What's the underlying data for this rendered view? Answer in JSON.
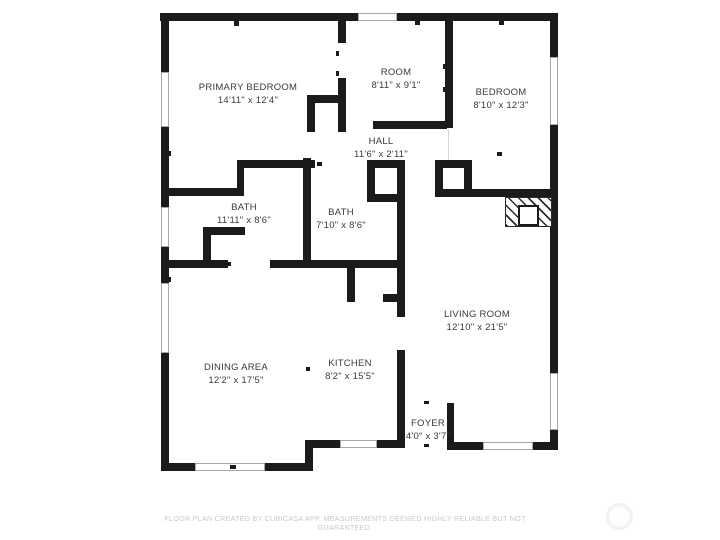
{
  "page": {
    "background": "#ffffff",
    "wall_color": "#1b1b1b",
    "label_color": "#3a3a3a",
    "window_border_color": "#a8a8a8",
    "footer_color": "#c9c9c9"
  },
  "footer": {
    "disclaimer": "FLOOR PLAN CREATED BY CUBICASA APP. MEASUREMENTS DEEMED HIGHLY RELIABLE BUT NOT GUARANTEED."
  },
  "rooms": [
    {
      "name": "PRIMARY BEDROOM",
      "dims": "14'11\" x 12'4\"",
      "cx": 248,
      "cy": 94
    },
    {
      "name": "ROOM",
      "dims": "8'11\" x 9'1\"",
      "cx": 396,
      "cy": 79
    },
    {
      "name": "BEDROOM",
      "dims": "8'10\" x 12'3\"",
      "cx": 501,
      "cy": 99
    },
    {
      "name": "HALL",
      "dims": "11'6\" x 2'11\"",
      "cx": 381,
      "cy": 148
    },
    {
      "name": "BATH",
      "dims": "11'11\" x 8'6\"",
      "cx": 244,
      "cy": 214
    },
    {
      "name": "BATH",
      "dims": "7'10\" x 8'6\"",
      "cx": 341,
      "cy": 219
    },
    {
      "name": "LIVING ROOM",
      "dims": "12'10\" x 21'5\"",
      "cx": 477,
      "cy": 321
    },
    {
      "name": "DINING AREA",
      "dims": "12'2\" x 17'5\"",
      "cx": 236,
      "cy": 374
    },
    {
      "name": "KITCHEN",
      "dims": "8'2\" x 15'5\"",
      "cx": 350,
      "cy": 370
    },
    {
      "name": "FOYER",
      "dims": "4'0\" x 3'7\"",
      "cx": 428,
      "cy": 430
    }
  ],
  "geometry": {
    "walls": [
      [
        160,
        13,
        198,
        8
      ],
      [
        397,
        13,
        161,
        8
      ],
      [
        161,
        13,
        8,
        59
      ],
      [
        161,
        127,
        8,
        80
      ],
      [
        161,
        247,
        8,
        36
      ],
      [
        161,
        353,
        8,
        118
      ],
      [
        161,
        463,
        34,
        8
      ],
      [
        265,
        463,
        48,
        8
      ],
      [
        305,
        440,
        8,
        31
      ],
      [
        305,
        440,
        35,
        8
      ],
      [
        377,
        440,
        26,
        8
      ],
      [
        397,
        350,
        8,
        98
      ],
      [
        447,
        442,
        36,
        8
      ],
      [
        533,
        442,
        25,
        8
      ],
      [
        447,
        403,
        7,
        42
      ],
      [
        550,
        13,
        8,
        44
      ],
      [
        550,
        125,
        8,
        248
      ],
      [
        550,
        430,
        8,
        20
      ],
      [
        338,
        21,
        8,
        22
      ],
      [
        338,
        78,
        8,
        54
      ],
      [
        307,
        95,
        36,
        8
      ],
      [
        307,
        103,
        8,
        29
      ],
      [
        373,
        121,
        74,
        8
      ],
      [
        445,
        21,
        8,
        107
      ],
      [
        237,
        160,
        78,
        8
      ],
      [
        237,
        160,
        7,
        36
      ],
      [
        165,
        188,
        79,
        8
      ],
      [
        203,
        227,
        8,
        33
      ],
      [
        203,
        227,
        42,
        8
      ],
      [
        303,
        158,
        8,
        110
      ],
      [
        397,
        160,
        8,
        157
      ],
      [
        367,
        160,
        8,
        42
      ],
      [
        367,
        194,
        36,
        8
      ],
      [
        367,
        160,
        36,
        8
      ],
      [
        161,
        260,
        67,
        8
      ],
      [
        270,
        260,
        135,
        8
      ],
      [
        347,
        260,
        8,
        42
      ],
      [
        383,
        294,
        22,
        8
      ],
      [
        435,
        160,
        8,
        37
      ],
      [
        464,
        160,
        8,
        37
      ],
      [
        435,
        160,
        37,
        8
      ],
      [
        435,
        189,
        118,
        8
      ]
    ],
    "windows": [
      [
        161,
        72,
        8,
        55
      ],
      [
        161,
        207,
        8,
        40
      ],
      [
        161,
        283,
        8,
        70
      ],
      [
        358,
        13,
        39,
        8
      ],
      [
        550,
        57,
        8,
        68
      ],
      [
        550,
        373,
        8,
        57
      ],
      [
        195,
        463,
        70,
        8
      ],
      [
        340,
        440,
        37,
        8
      ],
      [
        483,
        442,
        50,
        8
      ]
    ],
    "ticks": [
      [
        234,
        21,
        5,
        5
      ],
      [
        415,
        21,
        5,
        4
      ],
      [
        499,
        21,
        5,
        4
      ],
      [
        168,
        151,
        3,
        5
      ],
      [
        168,
        277,
        3,
        5
      ],
      [
        443,
        64,
        3,
        5
      ],
      [
        443,
        87,
        3,
        5
      ],
      [
        336,
        51,
        3,
        5
      ],
      [
        336,
        71,
        3,
        5
      ],
      [
        227,
        262,
        4,
        4
      ],
      [
        308,
        206,
        3,
        5
      ],
      [
        308,
        228,
        3,
        5
      ],
      [
        317,
        162,
        5,
        4
      ],
      [
        497,
        152,
        5,
        4
      ],
      [
        230,
        465,
        6,
        4
      ],
      [
        424,
        401,
        5,
        3
      ],
      [
        424,
        444,
        5,
        3
      ],
      [
        306,
        367,
        4,
        4
      ]
    ],
    "open_lines": [
      [
        448,
        129,
        1,
        31
      ]
    ],
    "fireplace": {
      "hatch": [
        505,
        197,
        47,
        30
      ],
      "insert": [
        518,
        205,
        21,
        21
      ]
    },
    "compass": {
      "x": 606,
      "y": 503,
      "d": 27
    }
  }
}
